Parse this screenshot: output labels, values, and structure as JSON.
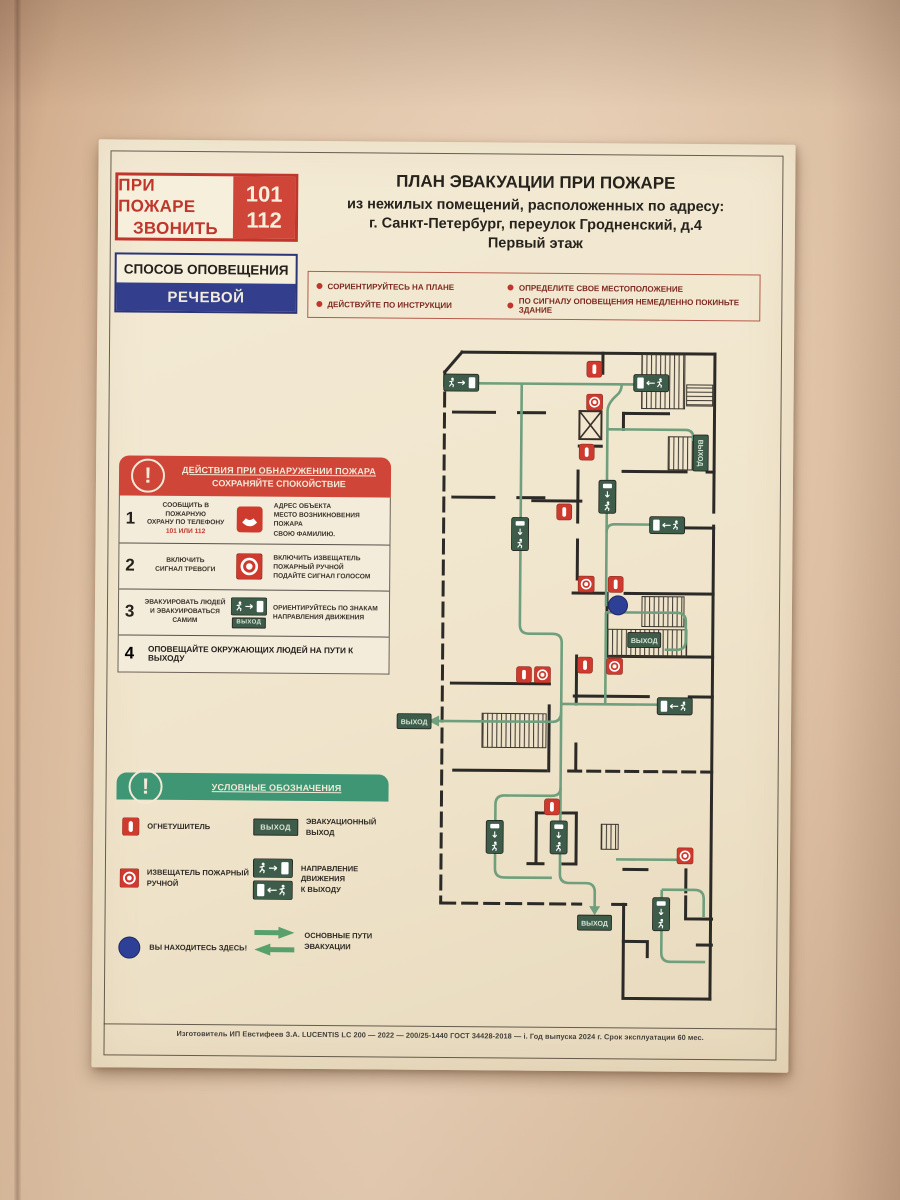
{
  "poster": {
    "emergency_call": {
      "line1": "ПРИ ПОЖАРЕ",
      "line2": "ЗВОНИТЬ",
      "num1": "101",
      "num2": "112"
    },
    "notification": {
      "label": "СПОСОБ ОПОВЕЩЕНИЯ",
      "value": "РЕЧЕВОЙ"
    },
    "title": {
      "line1": "ПЛАН ЭВАКУАЦИИ ПРИ ПОЖАРЕ",
      "line2": "из нежилых  помещений, расположенных по адресу:",
      "line3": "г. Санкт-Петербург, переулок Гродненский, д.4",
      "line4": "Первый этаж"
    },
    "instructions": [
      "СОРИЕНТИРУЙТЕСЬ НА ПЛАНЕ",
      "ОПРЕДЕЛИТЕ СВОЕ МЕСТОПОЛОЖЕНИЕ",
      "ДЕЙСТВУЙТЕ ПО ИНСТРУКЦИИ",
      "ПО СИГНАЛУ ОПОВЕЩЕНИЯ НЕМЕДЛЕННО ПОКИНЬТЕ ЗДАНИЕ"
    ],
    "actions": {
      "title": "ДЕЙСТВИЯ ПРИ ОБНАРУЖЕНИИ ПОЖАРА",
      "subtitle": "СОХРАНЯЙТЕ СПОКОЙСТВИЕ",
      "exclamation": "!",
      "steps": [
        {
          "num": "1",
          "left": "СООБЩИТЬ В ПОЖАРНУЮ\nОХРАНУ ПО ТЕЛЕФОНУ",
          "phones": "101 ИЛИ 112",
          "right": "АДРЕС ОБЪЕКТА\nМЕСТО ВОЗНИКНОВЕНИЯ ПОЖАРА\nСВОЮ ФАМИЛИЮ."
        },
        {
          "num": "2",
          "left": "ВКЛЮЧИТЬ\nСИГНАЛ ТРЕВОГИ",
          "right": "ВКЛЮЧИТЬ ИЗВЕЩАТЕЛЬ\nПОЖАРНЫЙ РУЧНОЙ\nПОДАЙТЕ СИГНАЛ ГОЛОСОМ"
        },
        {
          "num": "3",
          "left": "ЭВАКУИРОВАТЬ ЛЮДЕЙ\nИ ЭВАКУИРОВАТЬСЯ\nСАМИМ",
          "right": "ОРИЕНТИРУЙТЕСЬ ПО ЗНАКАМ\nНАПРАВЛЕНИЯ ДВИЖЕНИЯ"
        },
        {
          "num": "4",
          "text": "ОПОВЕЩАЙТЕ ОКРУЖАЮЩИХ ЛЮДЕЙ НА ПУТИ К ВЫХОДУ"
        }
      ]
    },
    "legend": {
      "title": "УСЛОВНЫЕ ОБОЗНАЧЕНИЯ",
      "exclamation": "!",
      "items": {
        "extinguisher": "ОГНЕТУШИТЕЛЬ",
        "call_point": "ИЗВЕЩАТЕЛЬ ПОЖАРНЫЙ\nРУЧНОЙ",
        "you_are_here": "ВЫ НАХОДИТЕСЬ ЗДЕСЬ!",
        "evac_exit": "ЭВАКУАЦИОННЫЙ\nВЫХОД",
        "direction": "НАПРАВЛЕНИЕ\nДВИЖЕНИЯ\nК ВЫХОДУ",
        "main_routes": "ОСНОВНЫЕ ПУТИ\nЭВАКУАЦИИ"
      }
    },
    "plan": {
      "exit_label": "ВЫХОД"
    },
    "footer": "Изготовитель ИП Евстифеев З.А.  LUCENTIS LC 200 — 2022 — 200/25-1440 ГОСТ 34428-2018 — i. Год выпуска 2024 г. Срок эксплуатации 60 мес."
  },
  "colors": {
    "alarm_red": "#cf4538",
    "legend_green": "#3f9674",
    "sign_green": "#3d5c4a",
    "route_green": "#6f9f7d",
    "you_are_here_blue": "#2e3f96",
    "wall_black": "#2b2a26"
  }
}
